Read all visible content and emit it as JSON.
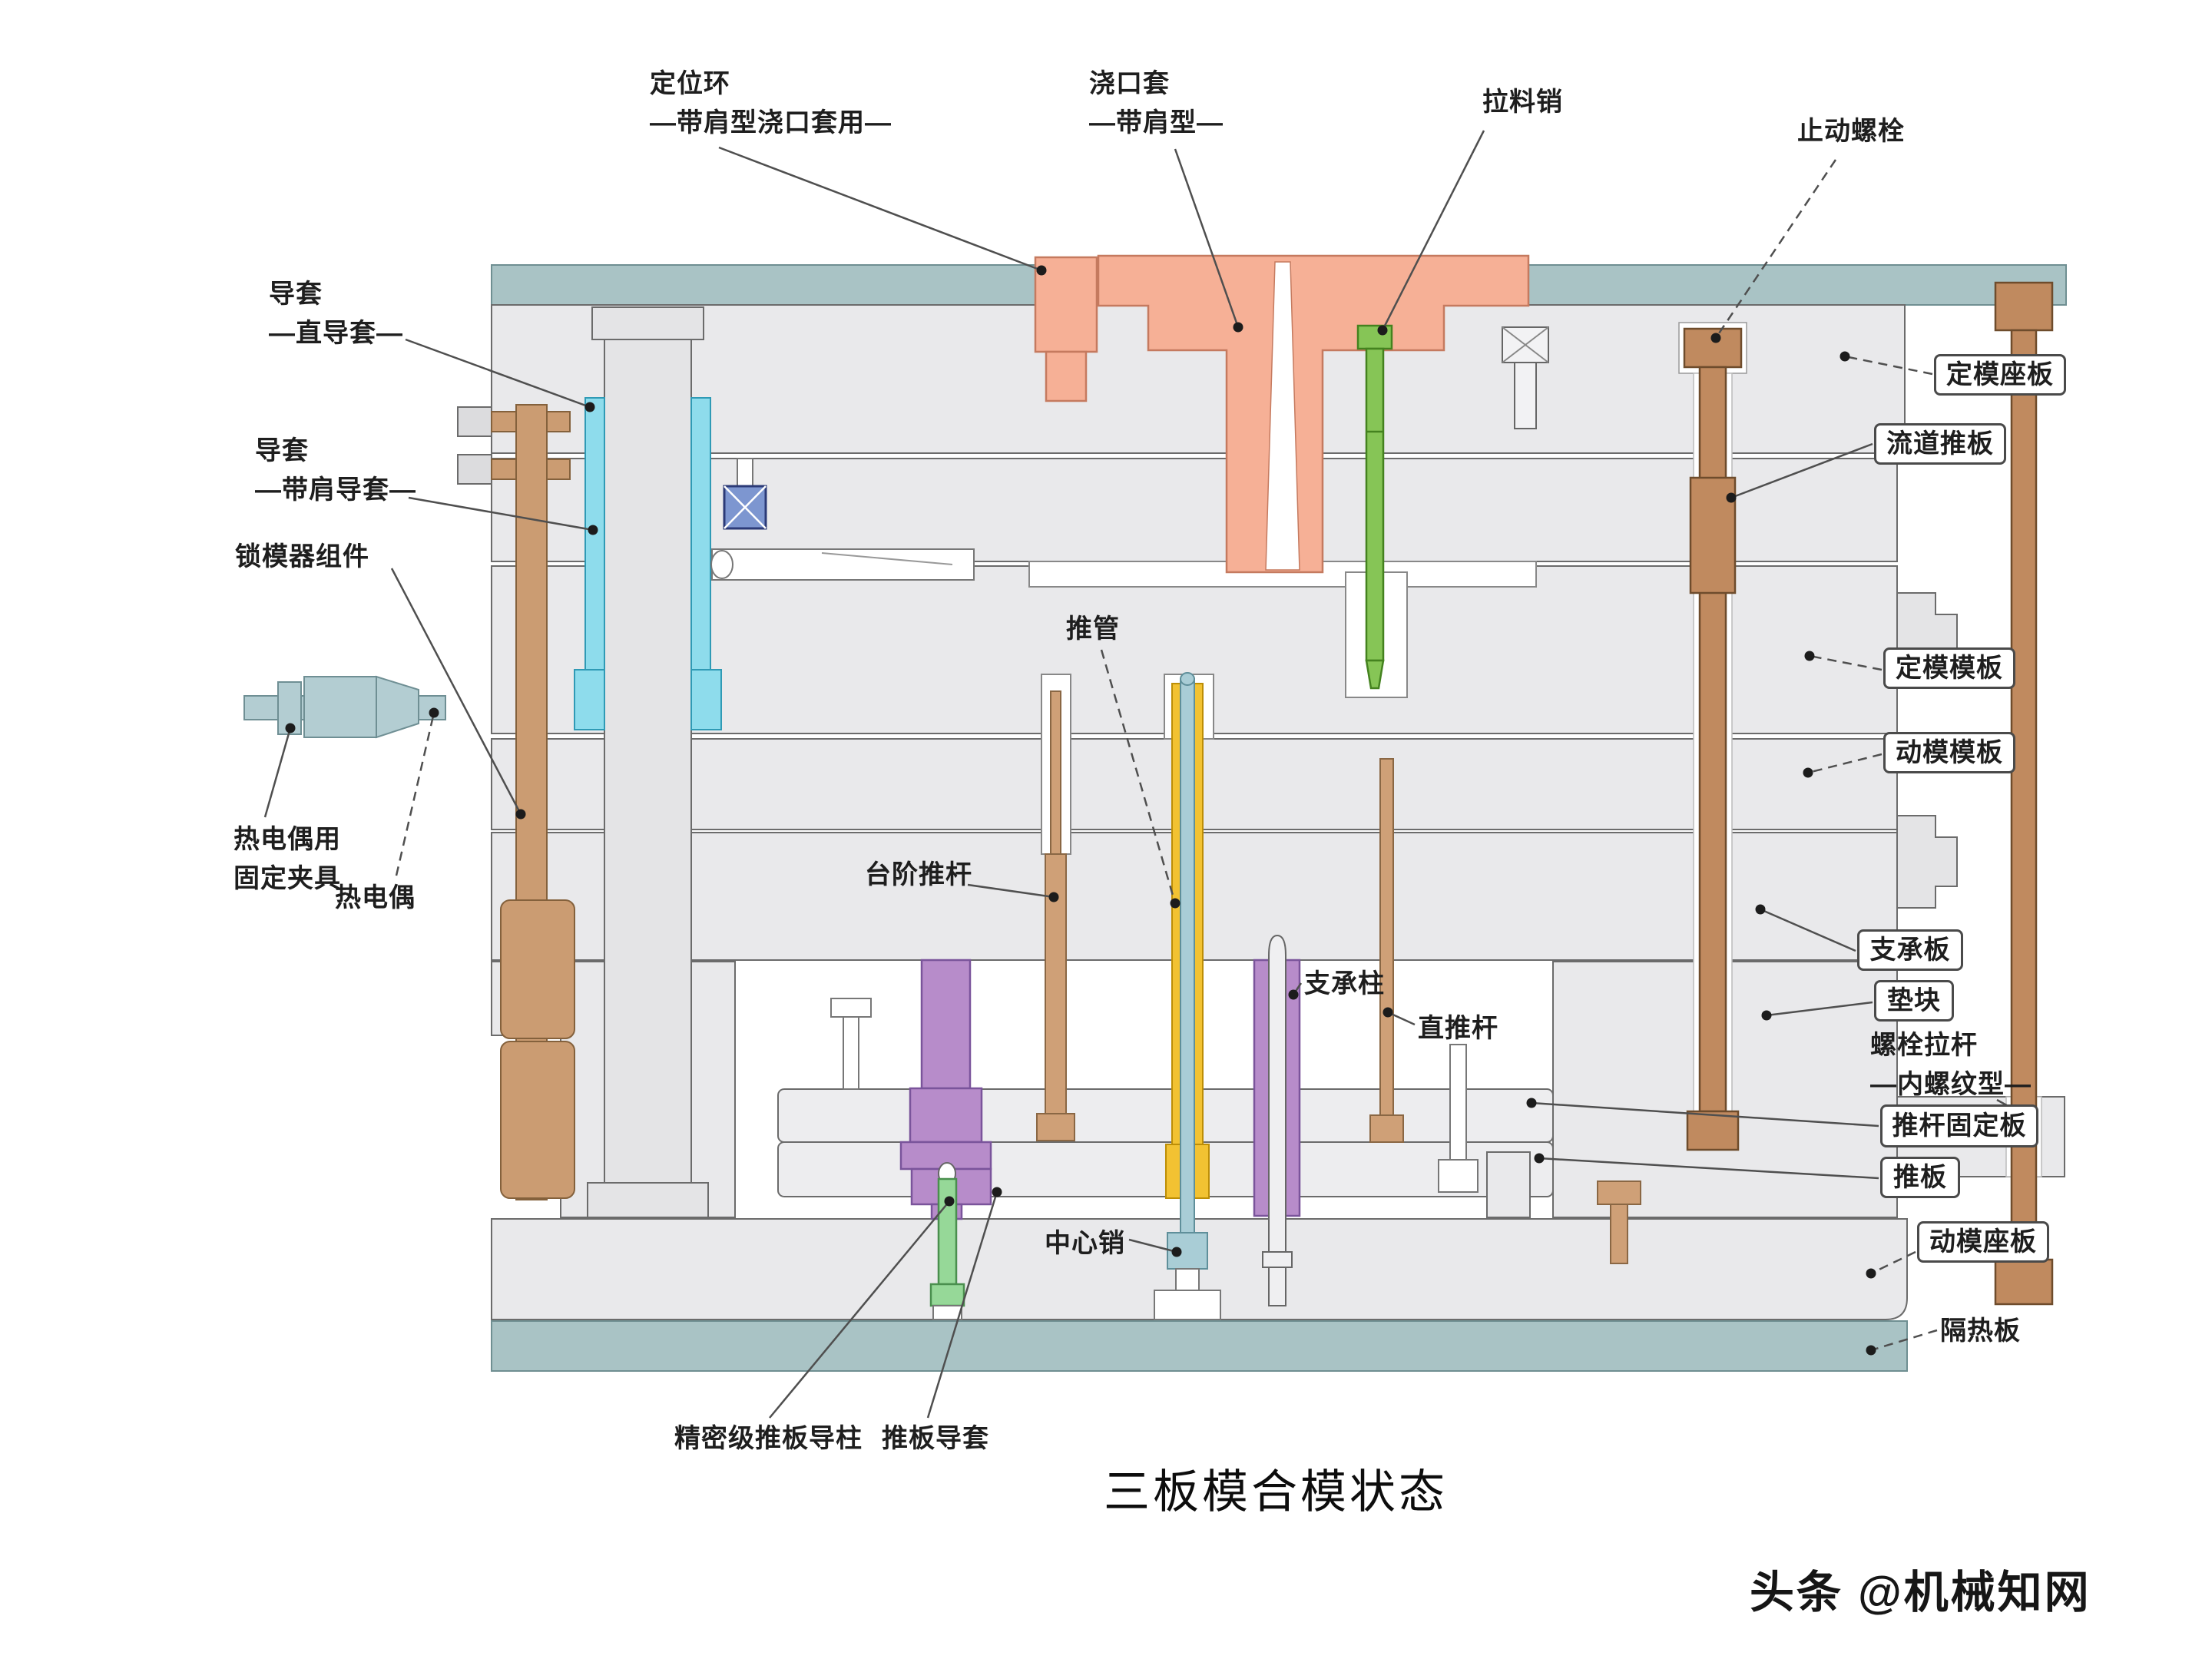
{
  "page": {
    "title": "三板模合模状态",
    "watermark": "头条 @机械知网"
  },
  "colors": {
    "plate_gray": "#e9e9eb",
    "insulation_teal": "#a9c3c5",
    "sprue_salmon": "#f6b096",
    "puller_green": "#86c556",
    "guide_cyan": "#8edcec",
    "block_blue": "#7d96d0",
    "bolt_tan": "#cb9c72",
    "pillar_purple": "#b78cca",
    "sleeve_yellow": "#f2c232",
    "pin_teal": "#a9cdd6"
  },
  "labels": {
    "locating_ring": "定位环\n—带肩型浇口套用—",
    "sprue_bushing": "浇口套\n—带肩型—",
    "puller_pin": "拉料销",
    "stop_bolt": "止动螺栓",
    "guide_bushing_straight": "导套\n—直导套—",
    "guide_bushing_shoulder": "导套\n—带肩导套—",
    "mold_lock_assembly": "锁模器组件",
    "thermocouple_clamp": "热电偶用\n固定夹具",
    "thermocouple": "热电偶",
    "fixed_clamp_plate": "定模座板",
    "runner_stripper_plate": "流道推板",
    "fixed_mold_plate": "定模模板",
    "moving_mold_plate": "动模模板",
    "support_plate": "支承板",
    "spacer_block": "垫块",
    "bolt_tie_rod": "螺栓拉杆\n—内螺纹型—",
    "ejector_retainer_plate": "推杆固定板",
    "ejector_plate": "推板",
    "moving_clamp_plate": "动模座板",
    "insulation_plate": "隔热板",
    "ejector_sleeve": "推管",
    "stepped_ejector_pin": "台阶推杆",
    "support_pillar": "支承柱",
    "straight_ejector_pin": "直推杆",
    "center_pin": "中心销",
    "precision_ejector_guide_pillar": "精密级推板导柱",
    "ejector_plate_guide_bushing": "推板导套"
  }
}
